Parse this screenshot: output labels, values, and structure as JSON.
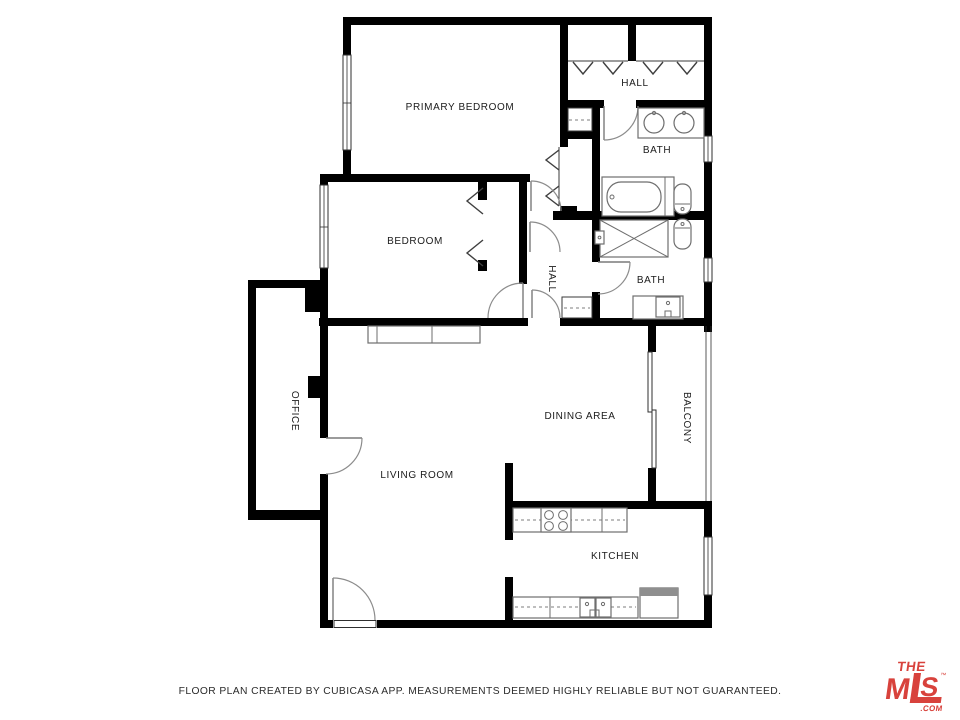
{
  "floor_plan": {
    "rooms": {
      "primary_bedroom": "PRIMARY BEDROOM",
      "hall_top": "HALL",
      "bath_top": "BATH",
      "bedroom": "BEDROOM",
      "hall_middle": "HALL",
      "bath_middle": "BATH",
      "office": "OFFICE",
      "dining_area": "DINING AREA",
      "balcony": "BALCONY",
      "living_room": "LIVING ROOM",
      "kitchen": "KITCHEN"
    },
    "wall_color": "#000000",
    "label_color": "#1b1b1b"
  },
  "footer": {
    "disclaimer": "FLOOR PLAN CREATED BY CUBICASA APP. MEASUREMENTS DEEMED HIGHLY RELIABLE BUT NOT GUARANTEED."
  },
  "logo": {
    "line1": "THE",
    "m": "M",
    "s": "S",
    "tm": "™",
    "com": ".COM",
    "color": "#d8423c"
  }
}
